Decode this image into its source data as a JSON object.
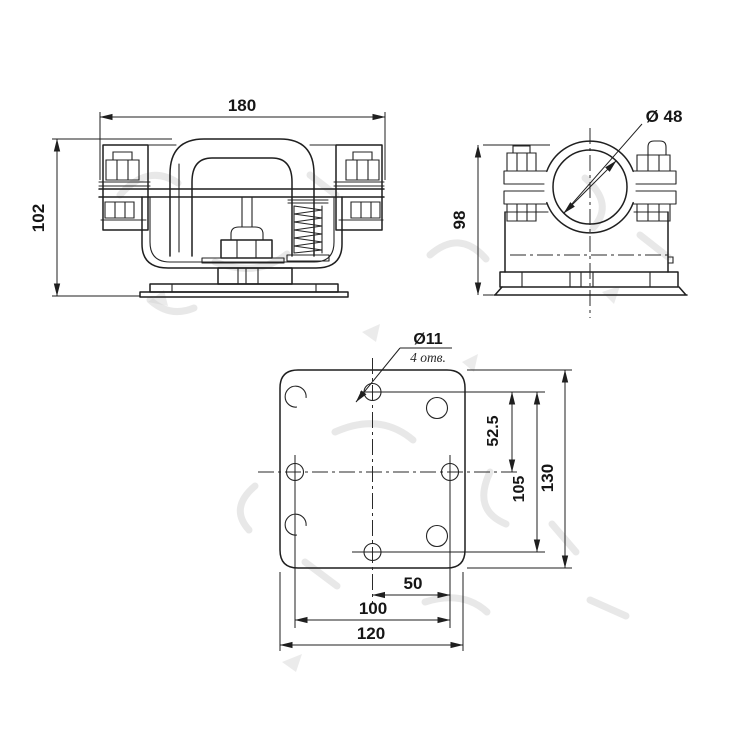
{
  "drawing": {
    "kind": "engineering drawing, clamp assembly, three views",
    "background": "#ffffff",
    "line_color": "#1f1f1f",
    "watermark_color": "#cdcdcd"
  },
  "front_view": {
    "label": "front view of clamp assembly",
    "width": "180",
    "height": "102"
  },
  "side_view": {
    "label": "side view of clamp",
    "height": "98",
    "bore": "Ø 48"
  },
  "plate_view": {
    "label": "base plate bottom view",
    "hole_diameter": "Ø11",
    "hole_count": "4 отв.",
    "offset_half": "52.5",
    "holes_vertical": "105",
    "height": "130",
    "center_offset": "50",
    "holes_horizontal": "100",
    "width": "120"
  }
}
